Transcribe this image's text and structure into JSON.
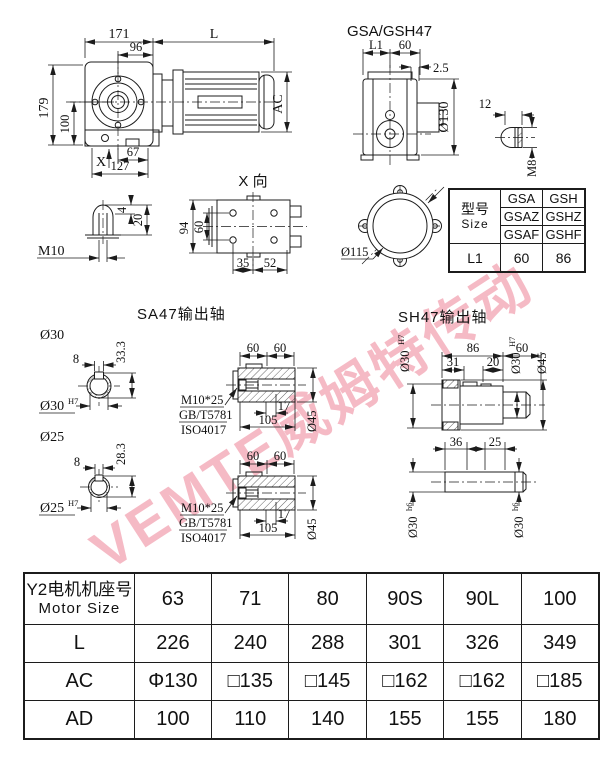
{
  "watermark": {
    "text": "VEMTE威姆特传动",
    "color": "rgba(236,130,150,0.55)"
  },
  "front_view": {
    "d171": "171",
    "dL": "L",
    "d96": "96",
    "d179": "179",
    "d100": "100",
    "dAC": "AC",
    "dX": "X",
    "d67": "67",
    "d127": "127"
  },
  "side_view": {
    "title": "GSA/GSH47",
    "dL1": "L1",
    "d60": "60",
    "d25": "2.5",
    "d130": "Ø130",
    "d12": "12",
    "dM8": "M8"
  },
  "shaft_end_view": {
    "dM10": "M10",
    "d4": "4",
    "d20": "20"
  },
  "x_view": {
    "title": "X 向",
    "d94": "94",
    "d60": "60",
    "d35": "35",
    "d52": "52"
  },
  "flange_view": {
    "d115": "Ø115"
  },
  "size_table": {
    "model_cn": "型号",
    "model_en": "Size",
    "gsa": [
      "GSA",
      "GSAZ",
      "GSAF"
    ],
    "gsh": [
      "GSH",
      "GSHZ",
      "GSHF"
    ],
    "l1_label": "L1",
    "l1_gsa": "60",
    "l1_gsh": "86"
  },
  "sa47": {
    "title": "SA47输出轴",
    "bore30": {
      "label": "Ø30",
      "d8": "8",
      "d333": "33.3",
      "dia": "Ø30",
      "tol": "H7"
    },
    "bore25": {
      "label": "Ø25",
      "d8": "8",
      "d283": "28.3",
      "dia": "Ø25",
      "tol": "H7"
    },
    "shaft_upper": {
      "d60a": "60",
      "d60b": "60",
      "d17": "17",
      "d105": "105",
      "d45": "Ø45",
      "bolt": "M10*25",
      "std1": "GB/T5781",
      "std2": "ISO4017"
    },
    "shaft_lower": {
      "d60a": "60",
      "d60b": "60",
      "d17": "17",
      "d105": "105",
      "d45": "Ø45",
      "bolt": "M10*25",
      "std1": "GB/T5781",
      "std2": "ISO4017"
    }
  },
  "sh47": {
    "title": "SH47输出轴",
    "upper": {
      "dia_l": "Ø30",
      "tol_l": "H7",
      "d86": "86",
      "d60": "60",
      "d31": "31",
      "d20": "20",
      "dia_r": "Ø30",
      "tol_r": "H7",
      "d45": "Ø45"
    },
    "lower": {
      "d36": "36",
      "d25": "25",
      "dia_l": "Ø30",
      "tol_l": "h6",
      "dia_r": "Ø30",
      "tol_r": "h6"
    }
  },
  "motor_table": {
    "header_cn": "Y2电机机座号",
    "header_en": "Motor Size",
    "sizes": [
      "63",
      "71",
      "80",
      "90S",
      "90L",
      "100"
    ],
    "row_l": {
      "label": "L",
      "values": [
        "226",
        "240",
        "288",
        "301",
        "326",
        "349"
      ]
    },
    "row_ac": {
      "label": "AC",
      "values": [
        "Φ130",
        "□135",
        "□145",
        "□162",
        "□162",
        "□185"
      ]
    },
    "row_ad": {
      "label": "AD",
      "values": [
        "100",
        "110",
        "140",
        "155",
        "155",
        "180"
      ]
    }
  }
}
